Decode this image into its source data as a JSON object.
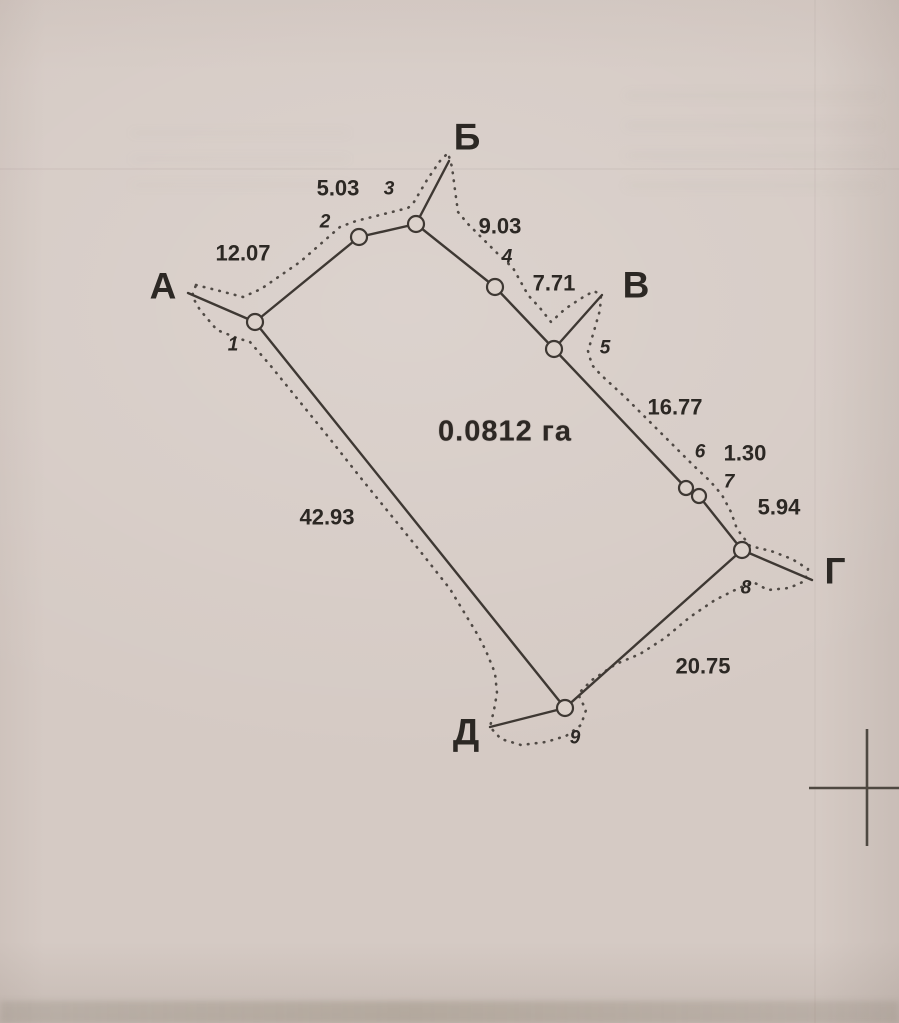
{
  "colors": {
    "paper": "#d5cac4",
    "paper_light": "#dcd2cb",
    "ink": "#3e3833",
    "text": "#2c2824",
    "cross": "#4e4841"
  },
  "diagram": {
    "area_label": "0.0812 га",
    "area_label_pos": {
      "x": 505,
      "y": 432
    },
    "corner_points": [
      {
        "id": "A",
        "label": "А",
        "x": 163,
        "y": 286
      },
      {
        "id": "B",
        "label": "Б",
        "x": 467,
        "y": 137
      },
      {
        "id": "V",
        "label": "В",
        "x": 636,
        "y": 285
      },
      {
        "id": "G",
        "label": "Г",
        "x": 835,
        "y": 571
      },
      {
        "id": "D",
        "label": "Д",
        "x": 466,
        "y": 732
      }
    ],
    "vertices": [
      {
        "n": "1",
        "x": 255,
        "y": 322,
        "r": 8,
        "lx": 233,
        "ly": 345
      },
      {
        "n": "2",
        "x": 359,
        "y": 237,
        "r": 8,
        "lx": 325,
        "ly": 222
      },
      {
        "n": "3",
        "x": 416,
        "y": 224,
        "r": 8,
        "lx": 389,
        "ly": 189
      },
      {
        "n": "4",
        "x": 495,
        "y": 287,
        "r": 8,
        "lx": 507,
        "ly": 257
      },
      {
        "n": "5",
        "x": 554,
        "y": 349,
        "r": 8,
        "lx": 605,
        "ly": 348
      },
      {
        "n": "6",
        "x": 686,
        "y": 488,
        "r": 7,
        "lx": 700,
        "ly": 452
      },
      {
        "n": "7",
        "x": 699,
        "y": 496,
        "r": 7,
        "lx": 729,
        "ly": 482
      },
      {
        "n": "8",
        "x": 742,
        "y": 550,
        "r": 8,
        "lx": 746,
        "ly": 588
      },
      {
        "n": "9",
        "x": 565,
        "y": 708,
        "r": 8,
        "lx": 575,
        "ly": 738
      }
    ],
    "solid_segments": [
      {
        "name": "spur-a",
        "from": [
          188,
          293
        ],
        "to": [
          255,
          322
        ]
      },
      {
        "name": "side-1-2",
        "from": [
          255,
          322
        ],
        "to": [
          359,
          237
        ]
      },
      {
        "name": "side-2-3",
        "from": [
          359,
          237
        ],
        "to": [
          416,
          224
        ]
      },
      {
        "name": "spur-b",
        "from": [
          416,
          224
        ],
        "to": [
          449,
          161
        ]
      },
      {
        "name": "side-3-4",
        "from": [
          416,
          224
        ],
        "to": [
          495,
          287
        ]
      },
      {
        "name": "side-4-5",
        "from": [
          495,
          287
        ],
        "to": [
          554,
          349
        ]
      },
      {
        "name": "spur-v",
        "from": [
          554,
          349
        ],
        "to": [
          602,
          295
        ]
      },
      {
        "name": "side-5-6",
        "from": [
          554,
          349
        ],
        "to": [
          686,
          488
        ]
      },
      {
        "name": "side-6-7",
        "from": [
          686,
          488
        ],
        "to": [
          699,
          496
        ]
      },
      {
        "name": "side-7-8",
        "from": [
          699,
          496
        ],
        "to": [
          742,
          550
        ]
      },
      {
        "name": "spur-g",
        "from": [
          742,
          550
        ],
        "to": [
          812,
          580
        ]
      },
      {
        "name": "side-8-9",
        "from": [
          742,
          550
        ],
        "to": [
          565,
          708
        ]
      },
      {
        "name": "spur-d",
        "from": [
          565,
          708
        ],
        "to": [
          490,
          727
        ]
      },
      {
        "name": "side-9-1",
        "from": [
          565,
          708
        ],
        "to": [
          255,
          322
        ]
      }
    ],
    "side_lengths": [
      {
        "side": "1-2",
        "value": "12.07",
        "x": 243,
        "y": 253
      },
      {
        "side": "2-3",
        "value": "5.03",
        "x": 338,
        "y": 188
      },
      {
        "side": "3-4",
        "value": "9.03",
        "x": 500,
        "y": 226
      },
      {
        "side": "4-5",
        "value": "7.71",
        "x": 554,
        "y": 283
      },
      {
        "side": "5-6",
        "value": "16.77",
        "x": 675,
        "y": 407
      },
      {
        "side": "6-7",
        "value": "1.30",
        "x": 745,
        "y": 453
      },
      {
        "side": "7-8",
        "value": "5.94",
        "x": 779,
        "y": 507
      },
      {
        "side": "8-9",
        "value": "20.75",
        "x": 703,
        "y": 666
      },
      {
        "side": "9-1",
        "value": "42.93",
        "x": 327,
        "y": 517
      }
    ],
    "dotted_boundary": [
      [
        196,
        285
      ],
      [
        220,
        291
      ],
      [
        243,
        297
      ],
      [
        261,
        289
      ],
      [
        300,
        262
      ],
      [
        340,
        227
      ],
      [
        356,
        221
      ],
      [
        384,
        214
      ],
      [
        408,
        208
      ],
      [
        414,
        202
      ],
      [
        427,
        180
      ],
      [
        440,
        161
      ],
      [
        448,
        153
      ],
      [
        452,
        167
      ],
      [
        455,
        190
      ],
      [
        458,
        212
      ],
      [
        468,
        224
      ],
      [
        483,
        239
      ],
      [
        498,
        254
      ],
      [
        513,
        268
      ],
      [
        528,
        295
      ],
      [
        540,
        308
      ],
      [
        551,
        322
      ],
      [
        565,
        309
      ],
      [
        580,
        299
      ],
      [
        594,
        291
      ],
      [
        601,
        295
      ],
      [
        600,
        310
      ],
      [
        594,
        331
      ],
      [
        588,
        351
      ],
      [
        592,
        365
      ],
      [
        601,
        375
      ],
      [
        625,
        397
      ],
      [
        654,
        426
      ],
      [
        678,
        450
      ],
      [
        694,
        466
      ],
      [
        710,
        481
      ],
      [
        722,
        495
      ],
      [
        731,
        512
      ],
      [
        737,
        529
      ],
      [
        750,
        546
      ],
      [
        771,
        551
      ],
      [
        792,
        559
      ],
      [
        808,
        569
      ],
      [
        805,
        581
      ],
      [
        789,
        588
      ],
      [
        768,
        590
      ],
      [
        753,
        582
      ],
      [
        739,
        588
      ],
      [
        715,
        600
      ],
      [
        690,
        617
      ],
      [
        665,
        638
      ],
      [
        640,
        654
      ],
      [
        616,
        664
      ],
      [
        592,
        680
      ],
      [
        578,
        694
      ],
      [
        586,
        710
      ],
      [
        581,
        725
      ],
      [
        566,
        736
      ],
      [
        546,
        742
      ],
      [
        521,
        745
      ],
      [
        501,
        739
      ],
      [
        490,
        727
      ],
      [
        494,
        710
      ],
      [
        497,
        693
      ],
      [
        495,
        673
      ],
      [
        486,
        651
      ],
      [
        479,
        637
      ],
      [
        450,
        589
      ],
      [
        420,
        551
      ],
      [
        390,
        514
      ],
      [
        360,
        477
      ],
      [
        330,
        439
      ],
      [
        300,
        402
      ],
      [
        270,
        365
      ],
      [
        250,
        342
      ],
      [
        237,
        338
      ],
      [
        217,
        330
      ],
      [
        200,
        310
      ],
      [
        192,
        296
      ],
      [
        196,
        285
      ]
    ],
    "cross_mark": {
      "horizontal": {
        "from": [
          809,
          788
        ],
        "to": [
          899,
          788
        ]
      },
      "vertical": {
        "from": [
          867,
          729
        ],
        "to": [
          867,
          846
        ]
      }
    }
  }
}
